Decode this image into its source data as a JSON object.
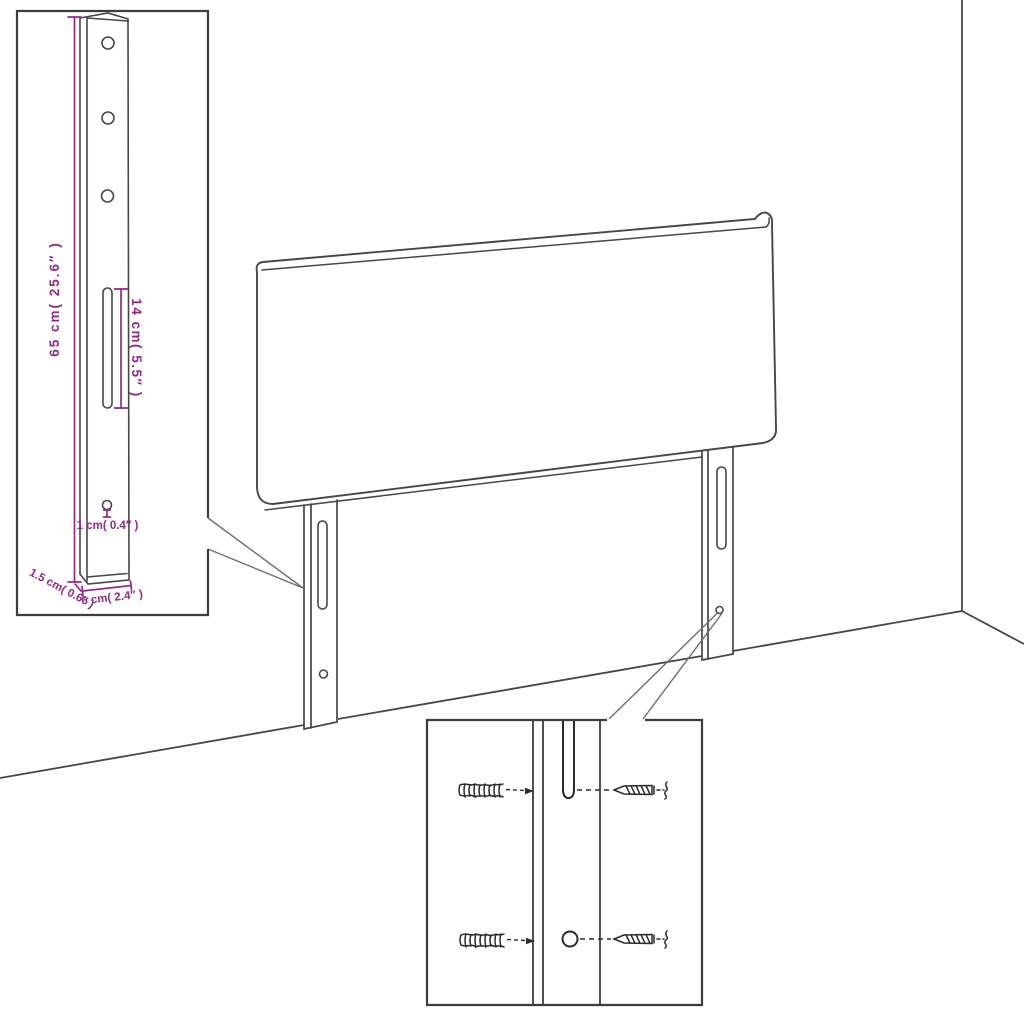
{
  "page": {
    "background_color": "#ffffff"
  },
  "diagram": {
    "type": "furniture-assembly-dimension-diagram",
    "subject": "Headboard with two mounting legs shown in a room corner, with leg dimension inset and wall-mounting hardware inset",
    "colors": {
      "line": "#474747",
      "dark_detail": "#2b2b2b",
      "accent": "#8E2C86",
      "background": "#ffffff"
    },
    "main_view": {
      "parts": [
        "headboard-panel",
        "left-leg",
        "right-leg",
        "wall-corner",
        "floor-line"
      ],
      "left_leg_features": [
        "slot",
        "screw-hole"
      ],
      "right_leg_features": [
        "slot",
        "screw-hole"
      ]
    },
    "leg_detail_inset": {
      "features": [
        "three-screw-holes",
        "long-slot",
        "small-hole"
      ],
      "dimensions": {
        "height": "65 cm( 25.6″ )",
        "slot_length": "14 cm( 5.5″ )",
        "hole": "1 cm( 0.4″ )",
        "depth": "1.5 cm( 0.6″ )",
        "width": "6 cm( 2.4″ )"
      }
    },
    "mounting_detail_inset": {
      "features": [
        "leg-slot",
        "leg-hole",
        "wall-plugs",
        "screws"
      ],
      "hardware": {
        "wall_plug_count": 2,
        "screw_count": 2
      }
    }
  }
}
